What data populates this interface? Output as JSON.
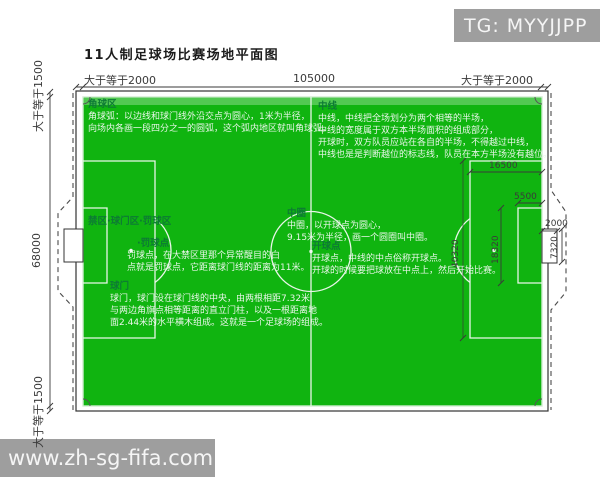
{
  "title": "11人制足球场比赛场地平面图",
  "watermarks": {
    "tg": "TG: MYYJJPP",
    "site": "www.zh-sg-fifa.com"
  },
  "dimensions": {
    "top_left": "大于等于2000",
    "top_center": "105000",
    "top_right": "大于等于2000",
    "left_top": "大于等于1500",
    "left_middle": "68000",
    "left_bottom": "大于等于1500",
    "penalty_area_depth": "16500",
    "goal_area_depth": "5500",
    "goal_depth": "2000",
    "goal_width": "7320",
    "goal_area_width": "18320",
    "penalty_area_width": "40320"
  },
  "annotations": {
    "corner_area": {
      "heading": "角球区",
      "lines": [
        "角球弧：以边线和球门线外沿交点为圆心，1米为半径，",
        "向场内各画一段四分之一的圆弧，这个弧内地区就叫角球弧。"
      ]
    },
    "mid_line": {
      "heading": "中线",
      "lines": [
        "中线，中线把全场划分为两个相等的半场，",
        "中线的宽度属于双方本半场面积的组成部分，",
        "开球时，双方队员应站在各自的半场，不得越过中线，",
        "中线也是是判断越位的标志线，队员在本方半场没有越位。"
      ]
    },
    "center_circle": {
      "heading": "中圈",
      "lines": [
        "中圈，以开球点为圆心，",
        "9.15米为半径，画一个圆圈叫中圈。"
      ]
    },
    "kickoff_point": {
      "heading": "开球点",
      "lines": [
        "开球点，中线的中点俗称开球点。",
        "开球的时候要把球放在中点上，然后开始比赛。"
      ]
    },
    "penalty_zone": {
      "heading": "禁区·球门区·罚球区"
    },
    "penalty_spot": {
      "heading": "·罚球点",
      "lines": [
        "罚球点，在大禁区里那个异常醒目的白",
        "点就是罚球点，它距离球门线的距离为11米。"
      ]
    },
    "goal": {
      "heading": "球门",
      "lines": [
        "球门，球门设在球门线的中央，由两根相距7.32米",
        "与两边角旗点相等距离的直立门柱，以及一根距离地",
        "面2.44米的水平横木组成。这就是一个足球场的组成。"
      ]
    }
  },
  "colors": {
    "field_green": "#10b410",
    "heading_green": "#0d7a35",
    "body_text": "#e9f6e9",
    "line_white": "#e8f6e8",
    "watermark_bg": "#9e9e9e"
  }
}
